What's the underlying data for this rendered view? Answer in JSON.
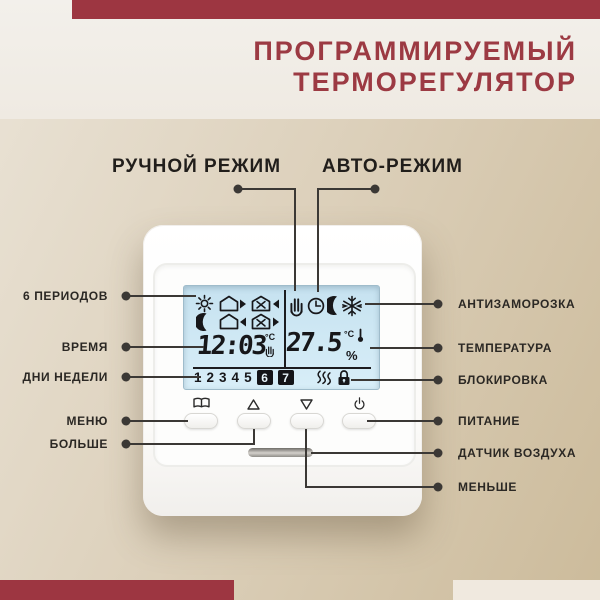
{
  "page": {
    "background_top": "#f2efe9",
    "background_main_from": "#eae3d6",
    "background_main_to": "#ccbb9b",
    "accent_red": "#9d3641",
    "title_color": "#9c3a43",
    "callout_line_color": "#3b3835",
    "lcd_color": "#cfe7f3"
  },
  "title": {
    "line1": "ПРОГРАММИРУЕМЫЙ",
    "line2": "ТЕРМОРЕГУЛЯТОР"
  },
  "modes": {
    "manual": "РУЧНОЙ РЕЖИМ",
    "auto": "АВТО-РЕЖИМ"
  },
  "callouts_left": [
    {
      "label": "6 ПЕРИОДОВ"
    },
    {
      "label": "ВРЕМЯ"
    },
    {
      "label": "ДНИ НЕДЕЛИ"
    },
    {
      "label": "МЕНЮ"
    },
    {
      "label": "БОЛЬШЕ"
    }
  ],
  "callouts_right": [
    {
      "label": "АНТИЗАМОРОЗКА"
    },
    {
      "label": "ТЕМПЕРАТУРА"
    },
    {
      "label": "БЛОКИРОВКА"
    },
    {
      "label": "ПИТАНИЕ"
    },
    {
      "label": "ДАТЧИК ВОЗДУХА"
    },
    {
      "label": "МЕНЬШЕ"
    }
  ],
  "display": {
    "time": "12:03",
    "time_unit": "°C",
    "temperature": "27.5",
    "temp_unit": "°C",
    "humidity_unit": "%",
    "days": [
      "1",
      "2",
      "3",
      "4",
      "5",
      "6",
      "7"
    ],
    "highlighted_days": "6,7",
    "period_icons": [
      "sun",
      "house-leave",
      "work-arrive",
      "moon",
      "house-return",
      "work-leave"
    ],
    "mode_icons": [
      "hand-manual",
      "clock-auto",
      "moon-night",
      "snowflake-antifreeze"
    ],
    "status_icons": [
      "heating-waves",
      "lock"
    ]
  }
}
